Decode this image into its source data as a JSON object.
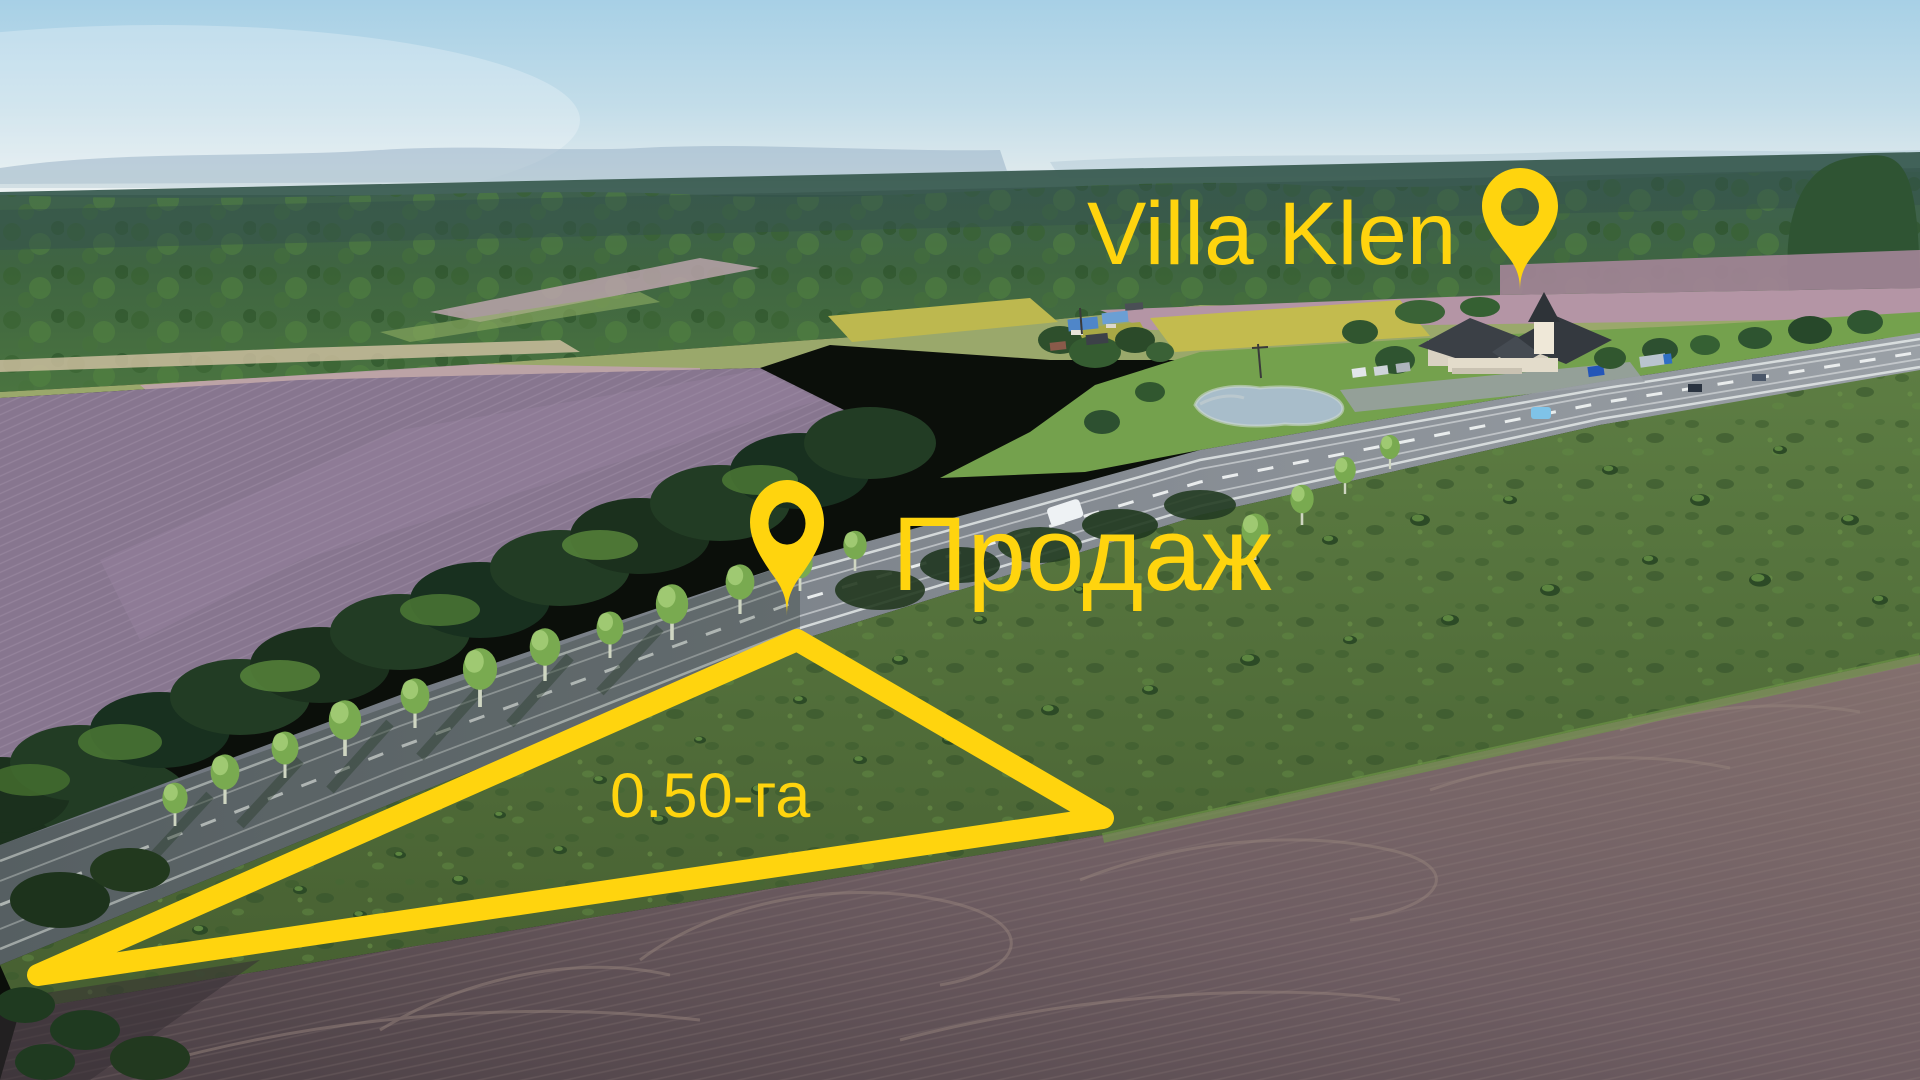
{
  "annotations": {
    "accent_color": "#ffd40e",
    "landmark": {
      "label": "Villa Klen",
      "icon": "map-pin-icon"
    },
    "sale": {
      "label": "Продаж",
      "icon": "map-pin-icon"
    },
    "plot": {
      "area_label": "0.50-га",
      "shape": "triangle-outline"
    }
  },
  "scene": {
    "type": "aerial-drone-photo",
    "features": [
      "sky",
      "distant-mountains",
      "forest",
      "plowed-fields",
      "highway",
      "roadside-trees",
      "pond",
      "villa-buildings",
      "village-houses",
      "scrub-meadow",
      "for-sale-plot"
    ]
  }
}
